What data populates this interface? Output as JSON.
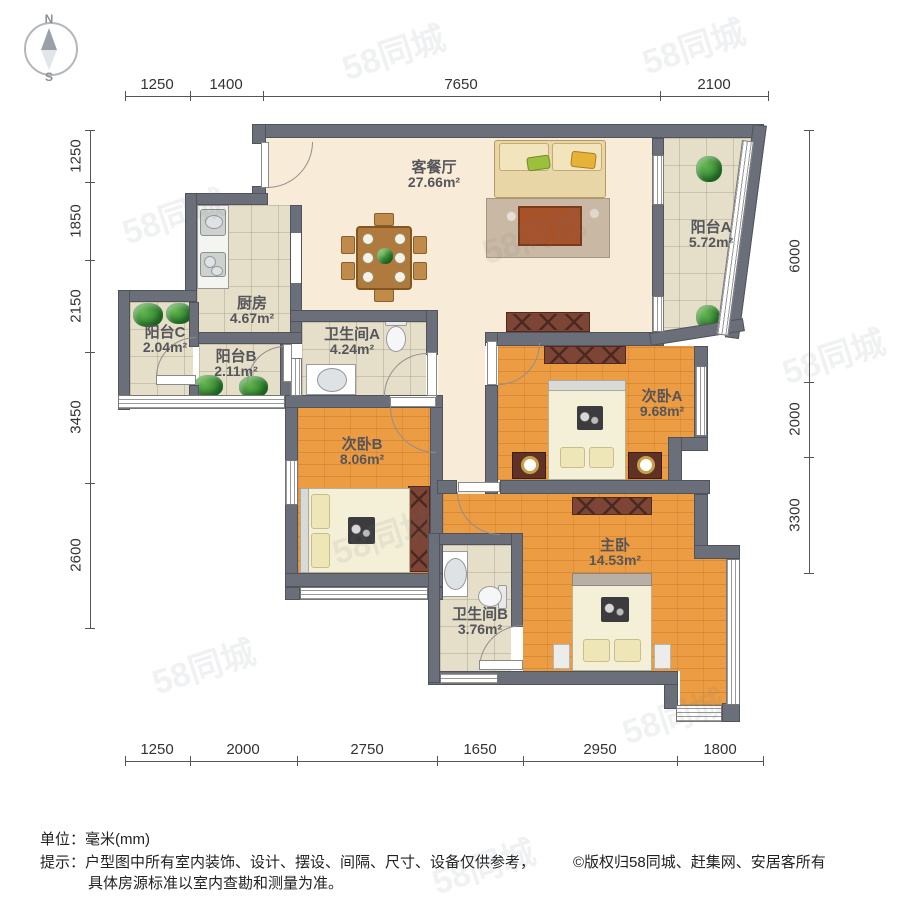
{
  "compass": {
    "north": "N",
    "south": "S"
  },
  "rooms": [
    {
      "name": "客餐厅",
      "area": "27.66m²"
    },
    {
      "name": "阳台A",
      "area": "5.72m²"
    },
    {
      "name": "厨房",
      "area": "4.67m²"
    },
    {
      "name": "阳台C",
      "area": "2.04m²"
    },
    {
      "name": "阳台B",
      "area": "2.11m²"
    },
    {
      "name": "卫生间A",
      "area": "4.24m²"
    },
    {
      "name": "次卧B",
      "area": "8.06m²"
    },
    {
      "name": "次卧A",
      "area": "9.68m²"
    },
    {
      "name": "主卧",
      "area": "14.53m²"
    },
    {
      "name": "卫生间B",
      "area": "3.76m²"
    }
  ],
  "dimensions": {
    "top": [
      "1250",
      "1400",
      "7650",
      "2100"
    ],
    "bottom": [
      "1250",
      "2000",
      "2750",
      "1650",
      "2950",
      "1800"
    ],
    "left": [
      "1250",
      "1850",
      "2150",
      "3450",
      "2600"
    ],
    "right": [
      "6000",
      "2000",
      "3300"
    ]
  },
  "footer": {
    "unit": "单位：毫米(mm)",
    "tip": "提示：户型图中所有室内装饰、设计、摆设、间隔、尺寸、设备仅供参考，",
    "tip2": "具体房源标准以室内查勘和测量为准。",
    "copyright": "©版权归58同城、赶集网、安居客所有"
  },
  "watermark": "58同城"
}
